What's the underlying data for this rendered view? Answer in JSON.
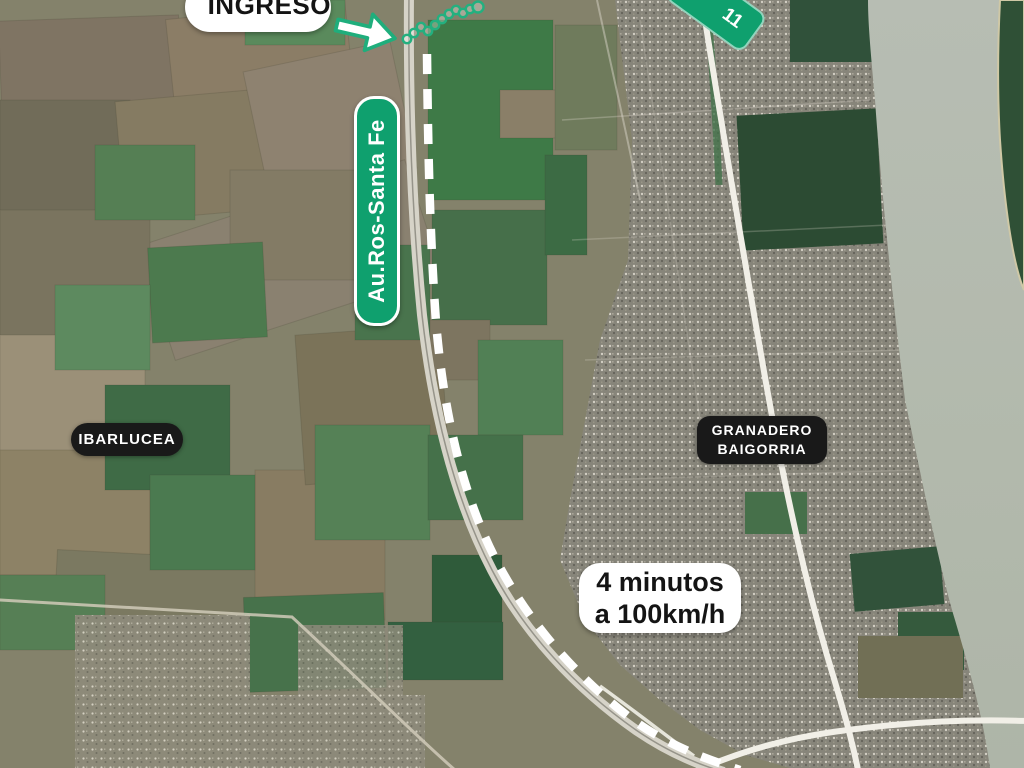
{
  "map": {
    "annotations": {
      "ingreso": "INGRESO",
      "route_shield": "11",
      "highway_name": "Au.Ros-Santa Fe",
      "town_ibarlucea": "IBARLUCEA",
      "town_granadero_line1": "GRANADERO",
      "town_granadero_line2": "BAIGORRIA",
      "travel_time_line1": "4 minutos",
      "travel_time_line2": "a 100km/h"
    },
    "colors": {
      "accent_green": "#0fa06e",
      "town_label_bg": "#191919",
      "white_label_bg": "#ffffff",
      "river_water": "#b5bcb0",
      "dashed_route": "#ffffff"
    },
    "icons": {
      "entry_arrow": "right-arrow-icon",
      "lot_boundary": "dotted-chain-icon",
      "route_shield": "route-shield-icon"
    }
  }
}
